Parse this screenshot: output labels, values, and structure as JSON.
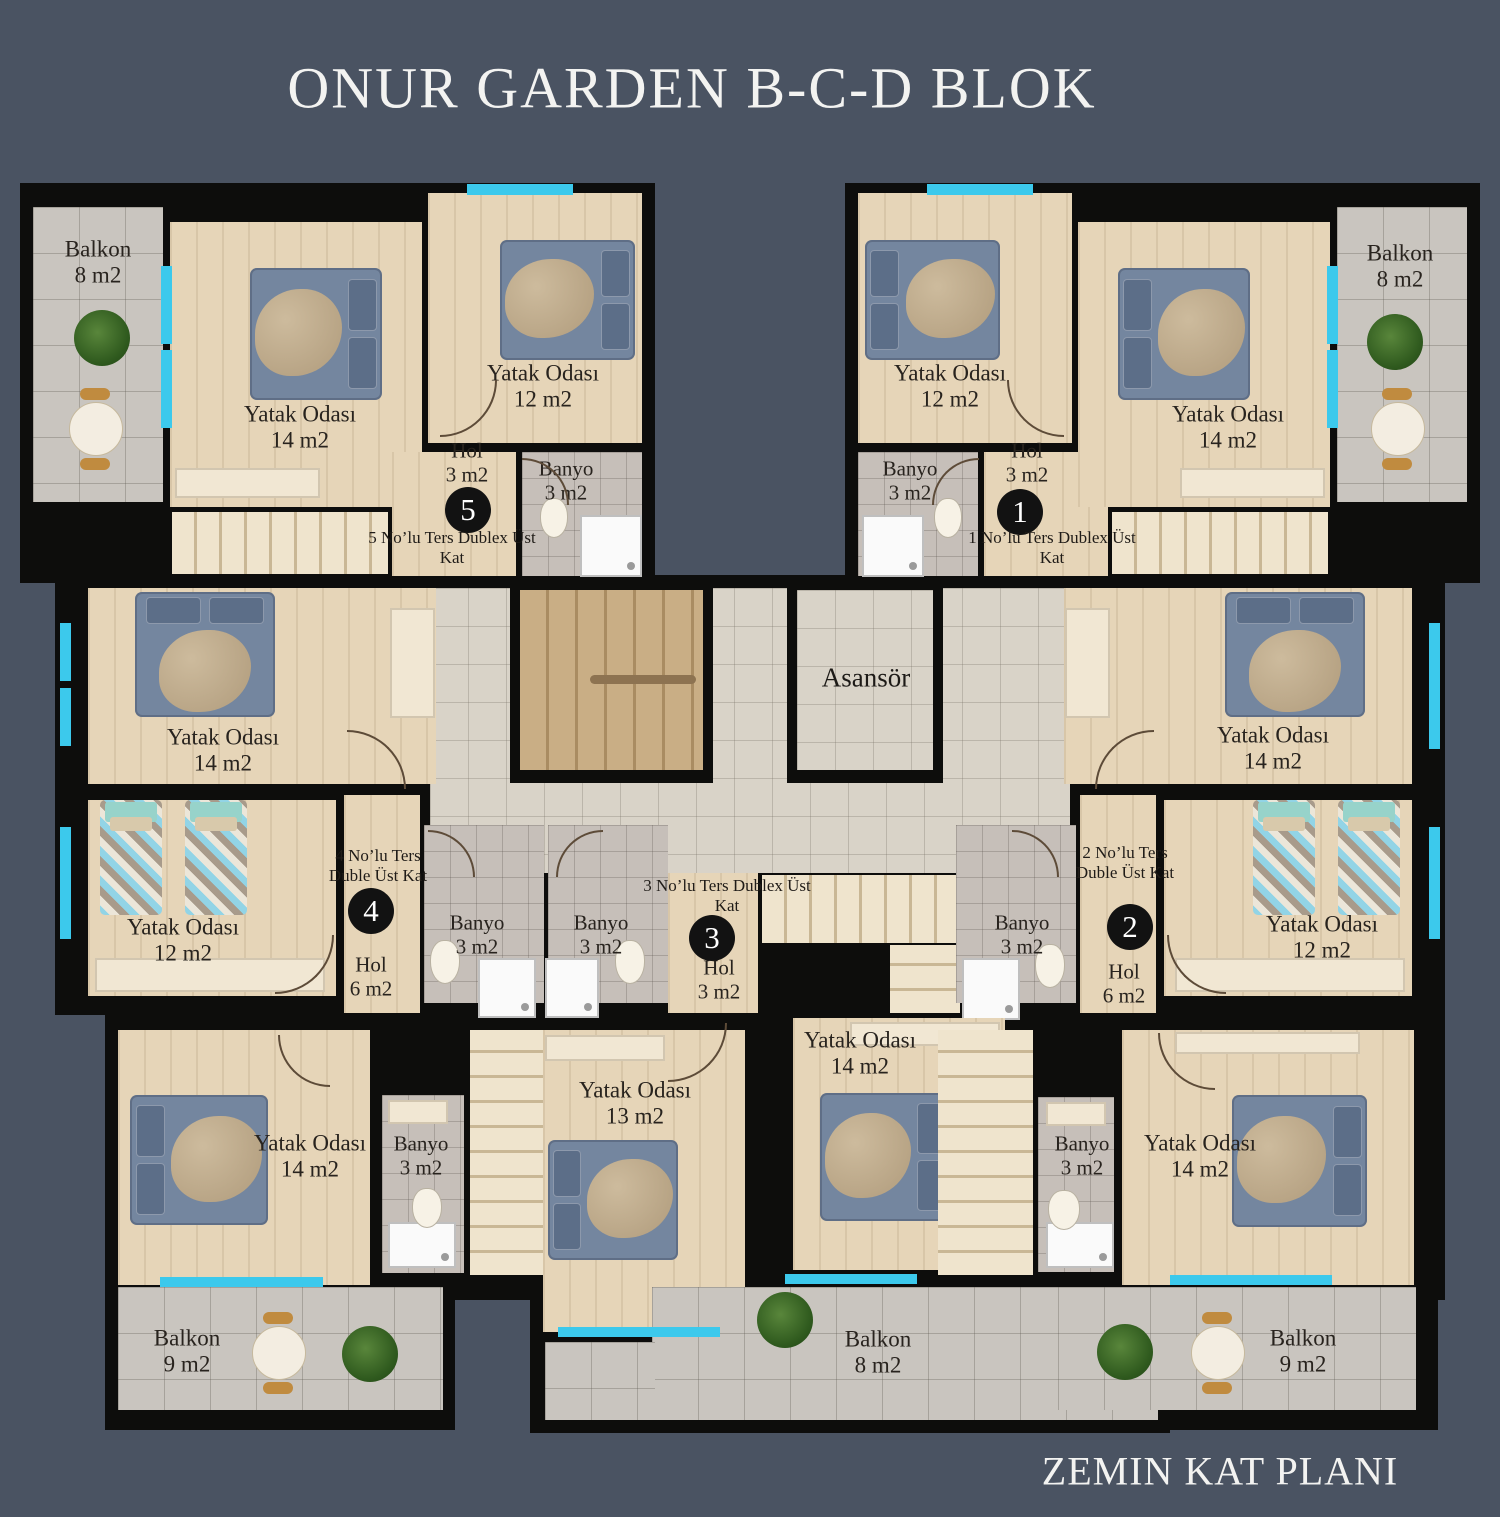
{
  "title": "ONUR GARDEN B-C-D BLOK",
  "plan_label": "ZEMIN KAT PLANI",
  "elevator": {
    "label": "Asansör"
  },
  "room_types": {
    "bedroom_14": {
      "name": "Yatak Odası",
      "area": "14 m2"
    },
    "bedroom_13": {
      "name": "Yatak Odası",
      "area": "13 m2"
    },
    "bedroom_12": {
      "name": "Yatak Odası",
      "area": "12 m2"
    },
    "bathroom_3": {
      "name": "Banyo",
      "area": "3 m2"
    },
    "balcony_8": {
      "name": "Balkon",
      "area": "8 m2"
    },
    "balcony_9": {
      "name": "Balkon",
      "area": "9 m2"
    }
  },
  "units": [
    {
      "number": "1",
      "note": "1 No’lu Ters Dublex Üst Kat",
      "hol": {
        "name": "Hol",
        "area": "3 m2"
      }
    },
    {
      "number": "2",
      "note": "2 No’lu Ters Duble Üst Kat",
      "hol": {
        "name": "Hol",
        "area": "6 m2"
      }
    },
    {
      "number": "3",
      "note": "3 No’lu Ters Dublex Üst Kat",
      "hol": {
        "name": "Hol",
        "area": "3 m2"
      }
    },
    {
      "number": "4",
      "note": "4 No’lu Ters Duble Üst Kat",
      "hol": {
        "name": "Hol",
        "area": "6 m2"
      }
    },
    {
      "number": "5",
      "note": "5 No’lu Ters Dublex Üst Kat",
      "hol": {
        "name": "Hol",
        "area": "3 m2"
      }
    }
  ],
  "colors": {
    "background": "#4a5362",
    "wall": "#0d0d0c",
    "wood_floor": "#e6d5b8",
    "corridor_tile": "#d9d3c8",
    "balcony_tile": "#c9c5bf",
    "window": "#3cc9ec",
    "title_text": "#f3f3f1",
    "label_text": "#28231e"
  }
}
